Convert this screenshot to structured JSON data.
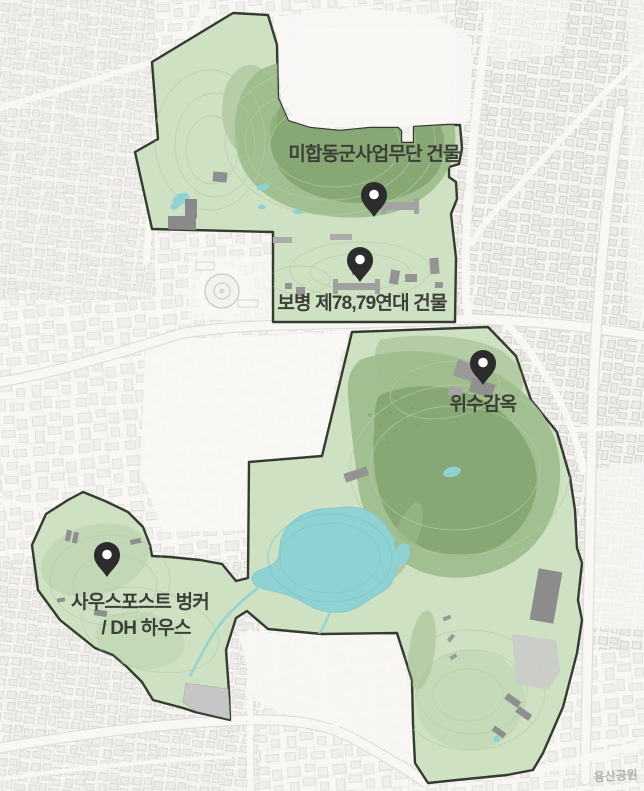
{
  "map": {
    "description_labels": [],
    "watermark": "용산공원"
  },
  "markers": [
    {
      "id": "us-joint-military-affairs-building",
      "label": "미합동군사업무단 건물"
    },
    {
      "id": "infantry-78-79-regiment-building",
      "label": "보병 제78,79연대 건물"
    },
    {
      "id": "wisu-prison",
      "label": "위수감옥"
    },
    {
      "id": "south-post-bunker-dh-house",
      "label_line1": "사우스포스트 벙커",
      "label_line2": "/ DH 하우스"
    }
  ],
  "colors": {
    "basemap_bg": "#f7f6f3",
    "park_fill": "#cee1c3",
    "park_outline": "#353b31",
    "hill_green": "#9dbb8c",
    "hill_green_dark": "#84a471",
    "water": "#8fd2d4",
    "water_ring": "#7ac4c8",
    "contour": "#b5cca6",
    "pin_color": "#2c2c2c",
    "label_text": "#3c3f38",
    "building_gray": "#949494",
    "watermark_color": "#a9a7a2"
  }
}
